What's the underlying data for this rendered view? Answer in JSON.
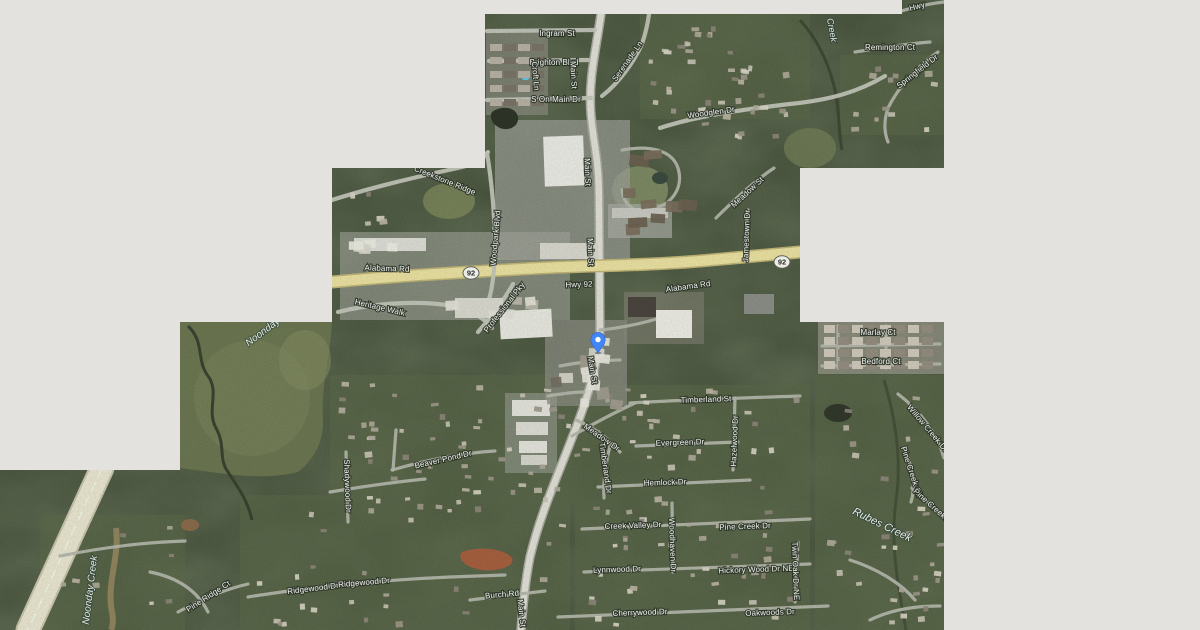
{
  "map": {
    "kind": "satellite-map",
    "colors": {
      "unloaded_tile_gray": "#e3e2de",
      "highway_yellow": "#eadfa2",
      "pin_blue": "#4285f4"
    },
    "pin": {
      "x": 598,
      "y": 353,
      "color": "#4285f4"
    },
    "route_shields": [
      {
        "text": "92",
        "x": 471,
        "y": 273
      },
      {
        "text": "92",
        "x": 782,
        "y": 262
      }
    ],
    "street_labels": [
      {
        "text": "Ingram St",
        "x": 557,
        "y": 33,
        "rot": 0
      },
      {
        "text": "Brighton Blvd",
        "x": 554,
        "y": 62,
        "rot": 0
      },
      {
        "text": "Croft Ln",
        "x": 536,
        "y": 76,
        "rot": 85
      },
      {
        "text": "Main St",
        "x": 574,
        "y": 75,
        "rot": 87
      },
      {
        "text": "S On Main Dr",
        "x": 556,
        "y": 99,
        "rot": 0
      },
      {
        "text": "Serenade Ln",
        "x": 627,
        "y": 61,
        "rot": -55
      },
      {
        "text": "Woodglen Dr",
        "x": 711,
        "y": 112,
        "rot": -8
      },
      {
        "text": "Remington Ct",
        "x": 890,
        "y": 47,
        "rot": 0
      },
      {
        "text": "Springfield Dr",
        "x": 917,
        "y": 71,
        "rot": -38
      },
      {
        "text": "Hwy",
        "x": 917,
        "y": 6,
        "rot": -15
      },
      {
        "text": "Creekstone Ridge",
        "x": 445,
        "y": 180,
        "rot": 22
      },
      {
        "text": "Woodpark Blvd",
        "x": 495,
        "y": 238,
        "rot": -85
      },
      {
        "text": "Alabama Rd",
        "x": 387,
        "y": 268,
        "rot": 2
      },
      {
        "text": "Hwy 92",
        "x": 579,
        "y": 284,
        "rot": -2
      },
      {
        "text": "Alabama Rd",
        "x": 688,
        "y": 286,
        "rot": -8
      },
      {
        "text": "Meadow St",
        "x": 747,
        "y": 192,
        "rot": -43
      },
      {
        "text": "Jamestown Dr",
        "x": 746,
        "y": 236,
        "rot": -88
      },
      {
        "text": "Main St",
        "x": 588,
        "y": 172,
        "rot": 88
      },
      {
        "text": "Main St",
        "x": 591,
        "y": 252,
        "rot": 88
      },
      {
        "text": "Main St",
        "x": 593,
        "y": 370,
        "rot": 80
      },
      {
        "text": "Heritage Walk",
        "x": 380,
        "y": 307,
        "rot": 13
      },
      {
        "text": "Professional Pky",
        "x": 504,
        "y": 307,
        "rot": -52
      },
      {
        "text": "Timberland St",
        "x": 706,
        "y": 399,
        "rot": -2
      },
      {
        "text": "Evergreen Dr",
        "x": 680,
        "y": 442,
        "rot": -2
      },
      {
        "text": "Hazelwood Dr",
        "x": 734,
        "y": 441,
        "rot": -88
      },
      {
        "text": "Hemlock Dr",
        "x": 665,
        "y": 482,
        "rot": -2
      },
      {
        "text": "Meadow Dr",
        "x": 602,
        "y": 437,
        "rot": 35
      },
      {
        "text": "Timberland Dr",
        "x": 606,
        "y": 468,
        "rot": 82
      },
      {
        "text": "Creek Valley Dr",
        "x": 633,
        "y": 525,
        "rot": -2
      },
      {
        "text": "Pine Creek Dr",
        "x": 745,
        "y": 526,
        "rot": -2
      },
      {
        "text": "Woodhaven Dr",
        "x": 673,
        "y": 545,
        "rot": 88
      },
      {
        "text": "Lynnwood Dr",
        "x": 617,
        "y": 569,
        "rot": -2
      },
      {
        "text": "Hickory Wood Dr NE",
        "x": 756,
        "y": 569,
        "rot": -2
      },
      {
        "text": "Twin Oak Dr NE",
        "x": 796,
        "y": 571,
        "rot": 88
      },
      {
        "text": "Cherrywood Dr",
        "x": 640,
        "y": 612,
        "rot": -2
      },
      {
        "text": "Oakwoods Dr",
        "x": 770,
        "y": 612,
        "rot": -2
      },
      {
        "text": "Marlay Ct",
        "x": 878,
        "y": 332,
        "rot": 0
      },
      {
        "text": "Bedford Ct",
        "x": 881,
        "y": 361,
        "rot": 0
      },
      {
        "text": "Willow Creek Dr",
        "x": 928,
        "y": 428,
        "rot": 50
      },
      {
        "text": "Pine Creek Cir",
        "x": 912,
        "y": 472,
        "rot": 72
      },
      {
        "text": "Pine Creek Dr",
        "x": 934,
        "y": 507,
        "rot": 42
      },
      {
        "text": "Pine Ridge Ct",
        "x": 208,
        "y": 596,
        "rot": -33
      },
      {
        "text": "Ridgewood Dr",
        "x": 313,
        "y": 588,
        "rot": -7
      },
      {
        "text": "Ridgewood Dr",
        "x": 364,
        "y": 582,
        "rot": -5
      },
      {
        "text": "Burch Rd",
        "x": 502,
        "y": 594,
        "rot": -5
      },
      {
        "text": "Main St",
        "x": 522,
        "y": 613,
        "rot": 83
      },
      {
        "text": "Beaver Pond Dr",
        "x": 443,
        "y": 459,
        "rot": -13
      },
      {
        "text": "Shadywood Dr",
        "x": 348,
        "y": 486,
        "rot": 88
      }
    ],
    "water_labels": [
      {
        "text": "Creek",
        "x": 832,
        "y": 30,
        "rot": 80,
        "size": 9
      },
      {
        "text": "Rubes Creek",
        "x": 882,
        "y": 525,
        "rot": 26,
        "size": 11
      },
      {
        "text": "Noonday Creek",
        "x": 90,
        "y": 590,
        "rot": -83,
        "size": 10
      },
      {
        "text": "Noonday Cr",
        "x": 268,
        "y": 328,
        "rot": -37,
        "size": 10
      }
    ]
  }
}
